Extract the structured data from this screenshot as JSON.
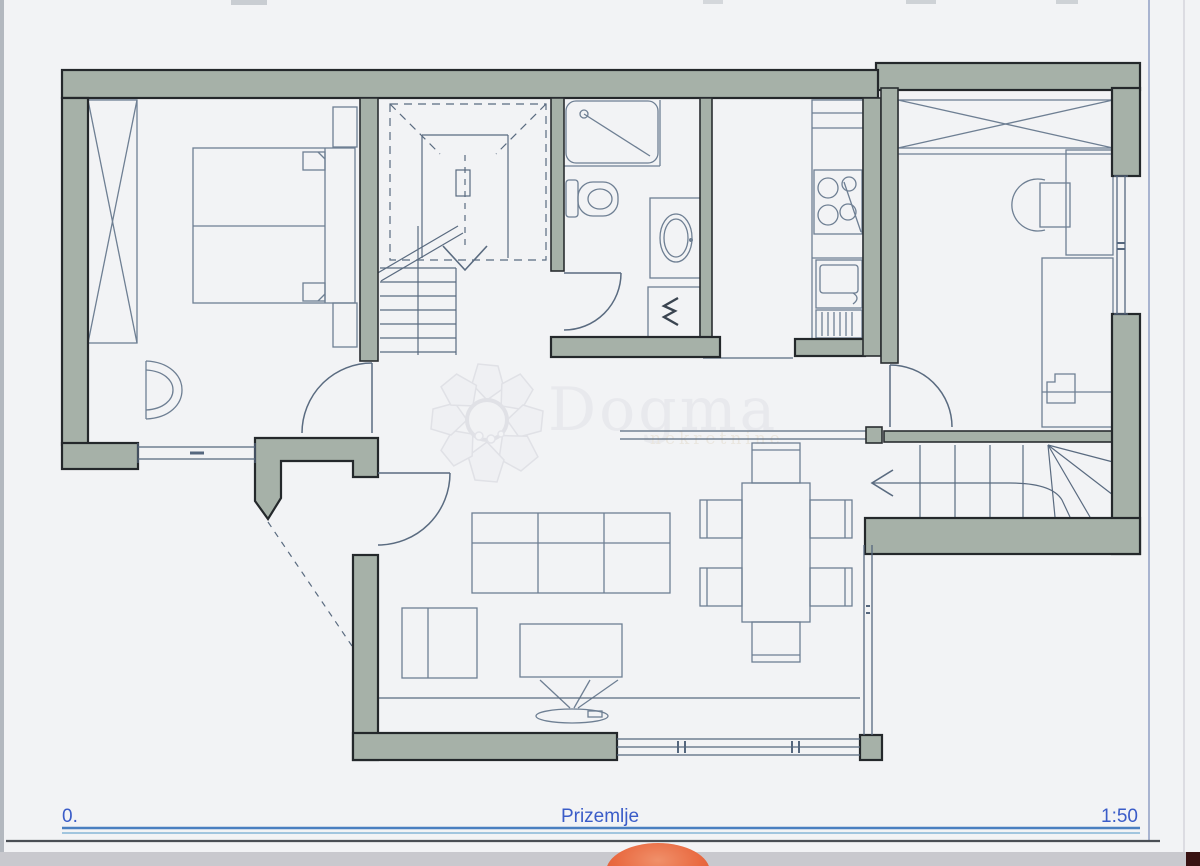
{
  "titlebar": {
    "level": "0.",
    "floor_name": "Prizemlje",
    "scale": "1:50"
  },
  "watermark": {
    "brand": "Dogma",
    "tagline": "nekretnine"
  },
  "colors": {
    "paper": "#f2f3f5",
    "wall_fill": "#a6b1a8",
    "wall_outline": "#24282b",
    "plan_line": "#5a6b80",
    "furniture_line": "#6e7f93",
    "title_text": "#3a5cc8",
    "underline_primary": "#4a7fc0",
    "underline_secondary": "#86b6d6",
    "scanner_strip": "#c9c9ce",
    "finger_smudge": "#e96a41",
    "corner_mark": "#381212"
  }
}
